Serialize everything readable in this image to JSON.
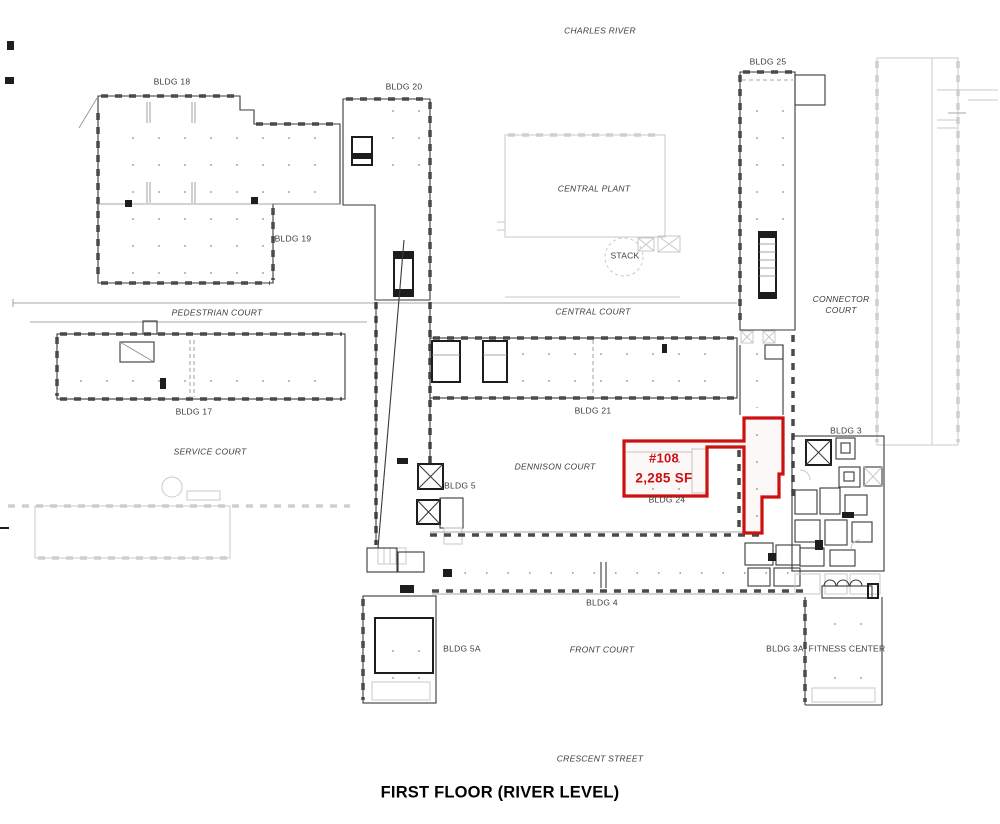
{
  "plan": {
    "title": "FIRST FLOOR (RIVER LEVEL)",
    "streets": {
      "charles_river": "CHARLES RIVER",
      "crescent_street": "CRESCENT STREET"
    },
    "courts": {
      "pedestrian": "PEDESTRIAN COURT",
      "central": "CENTRAL COURT",
      "connector_line1": "CONNECTOR",
      "connector_line2": "COURT",
      "service": "SERVICE COURT",
      "dennison": "DENNISON COURT",
      "front": "FRONT COURT"
    },
    "buildings": {
      "bldg18": "BLDG 18",
      "bldg19": "BLDG 19",
      "bldg20": "BLDG 20",
      "bldg25": "BLDG 25",
      "bldg17": "BLDG 17",
      "bldg21": "BLDG 21",
      "bldg24": "BLDG 24",
      "bldg3": "BLDG 3",
      "bldg4": "BLDG 4",
      "bldg5": "BLDG 5",
      "bldg5a": "BLDG 5A",
      "bldg3a": "BLDG 3A",
      "fitness_center": "FITNESS CENTER",
      "central_plant": "CENTRAL PLANT",
      "stack": "STACK"
    },
    "highlighted_unit": {
      "number": "#108",
      "area": "2,285 SF",
      "outline_color": "#cc1111"
    },
    "colors": {
      "wall_dark": "#3a3a3a",
      "wall_light": "#c9c9c9",
      "label_text": "#3c3c3c",
      "highlight_red": "#cc1111"
    }
  }
}
